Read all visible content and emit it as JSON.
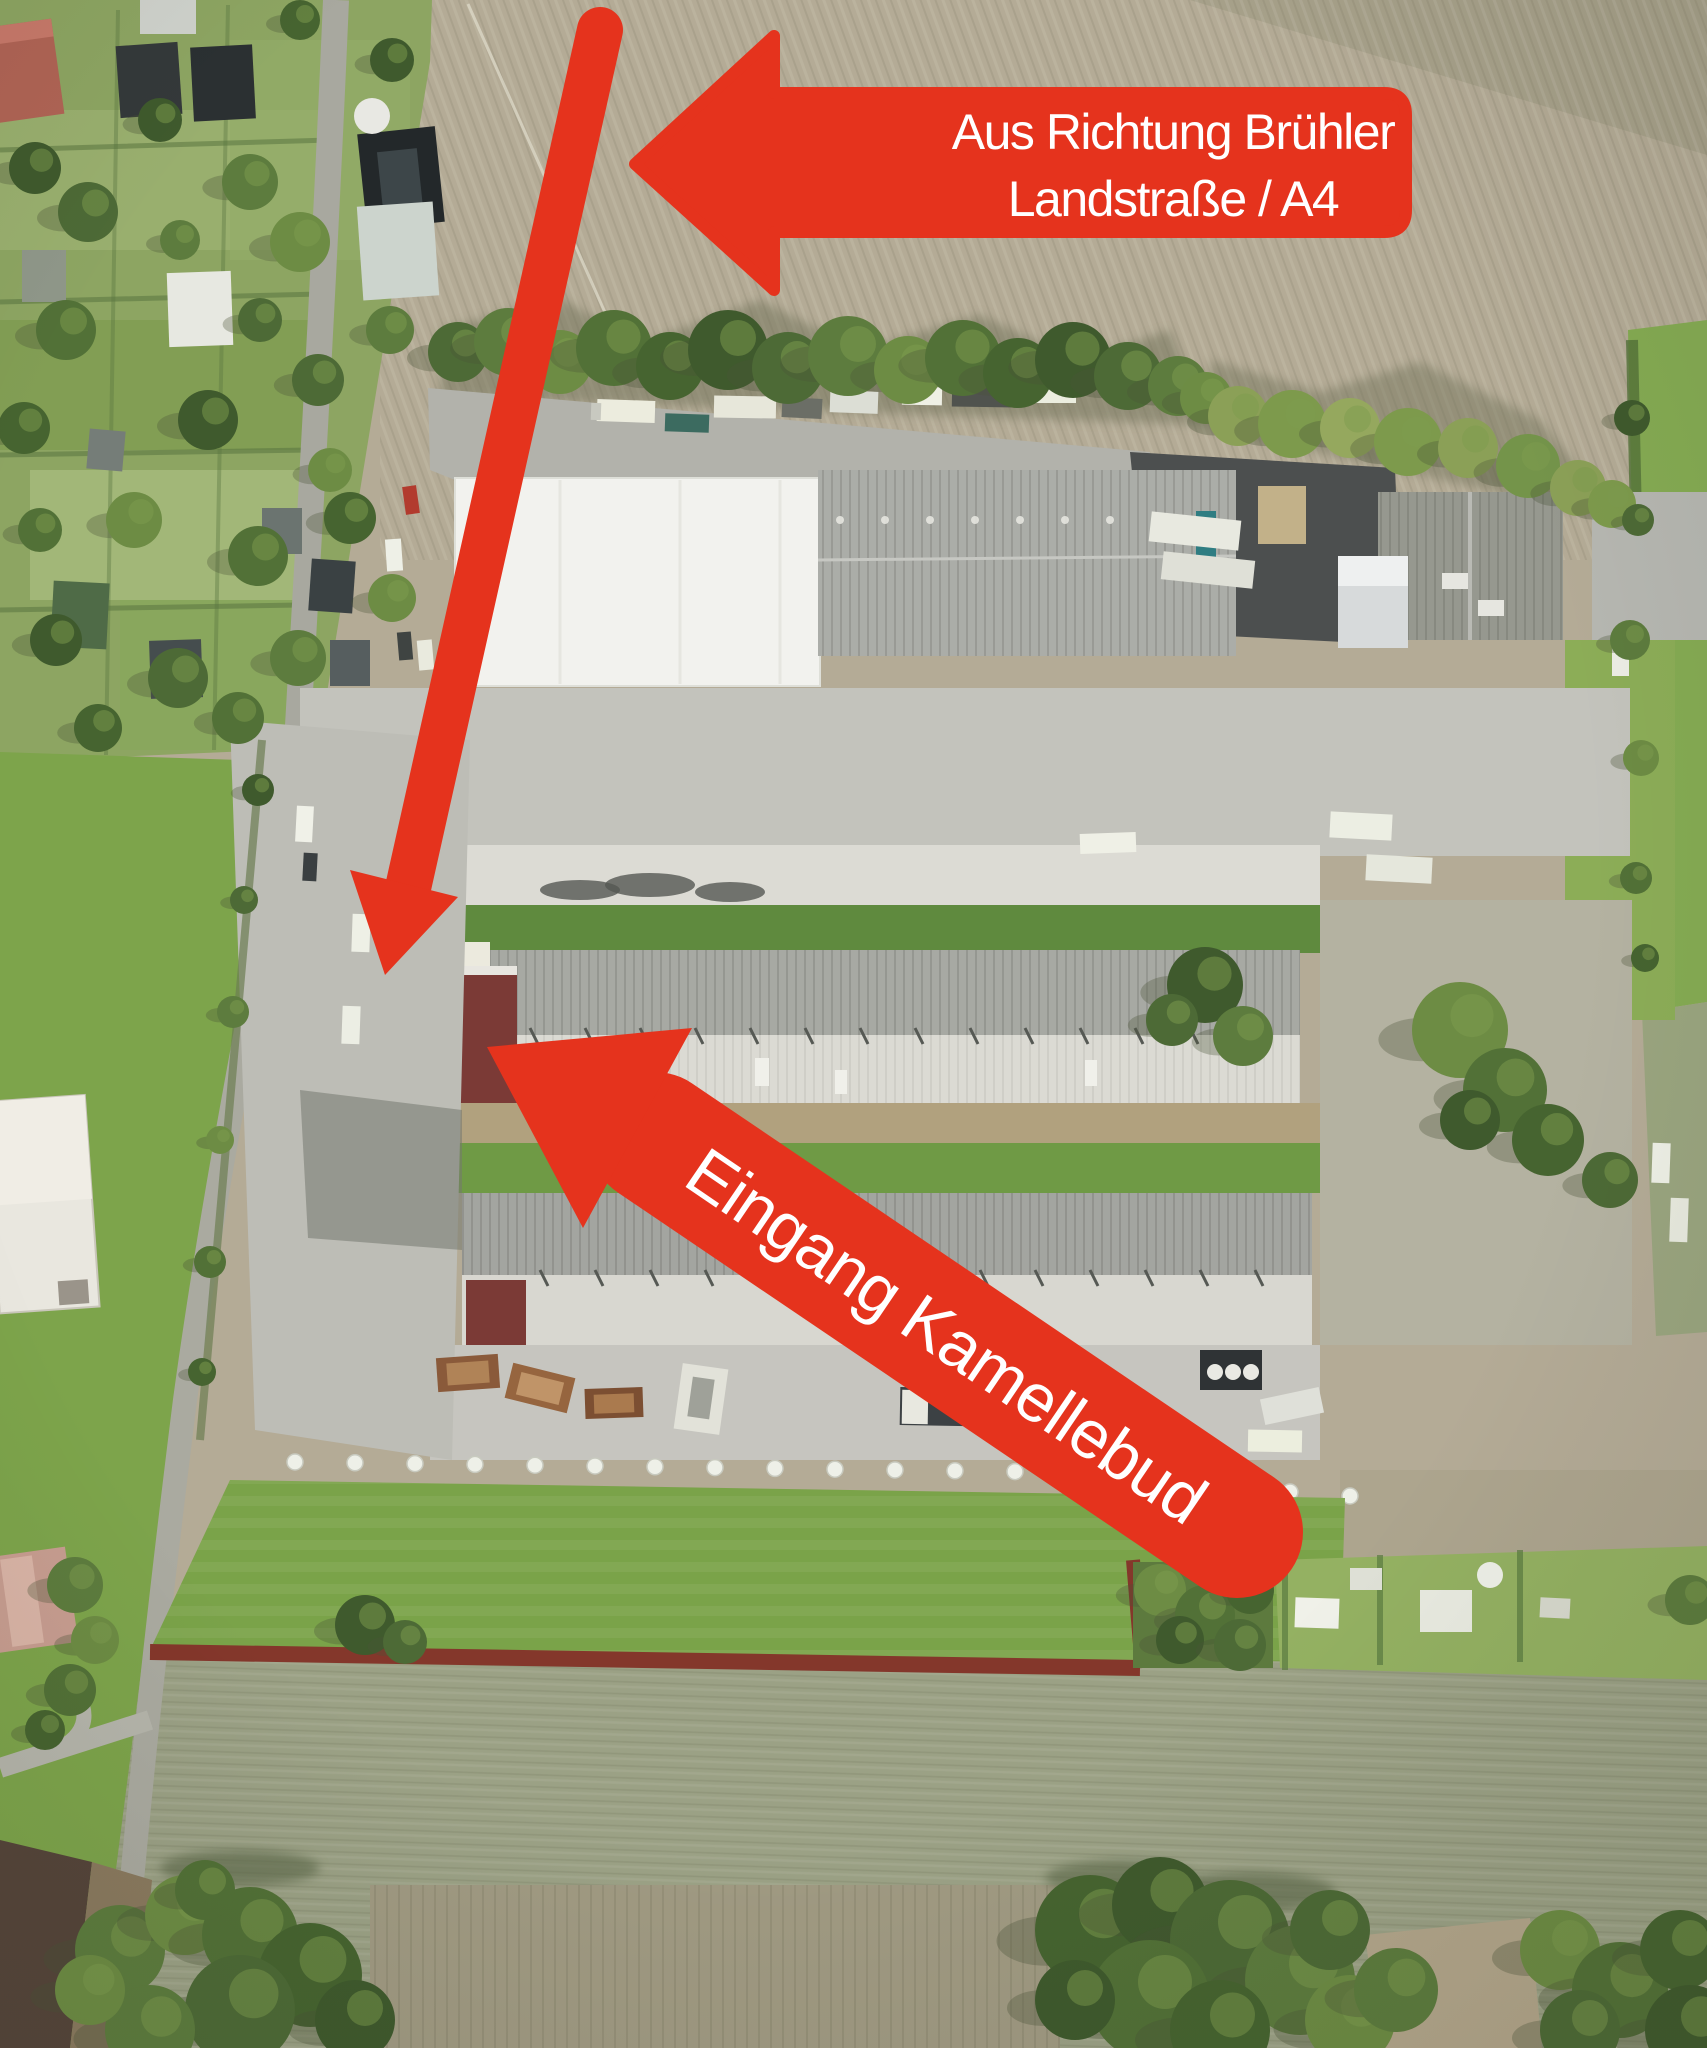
{
  "annotations": {
    "direction_banner": {
      "line1": "Aus Richtung Brühler",
      "line2": "Landstraße / A4"
    },
    "entrance_arrow": {
      "label": "Eingang Kamellebud"
    }
  },
  "colors": {
    "annotation_red": "#e5331d",
    "label_text": "#ffffff"
  }
}
